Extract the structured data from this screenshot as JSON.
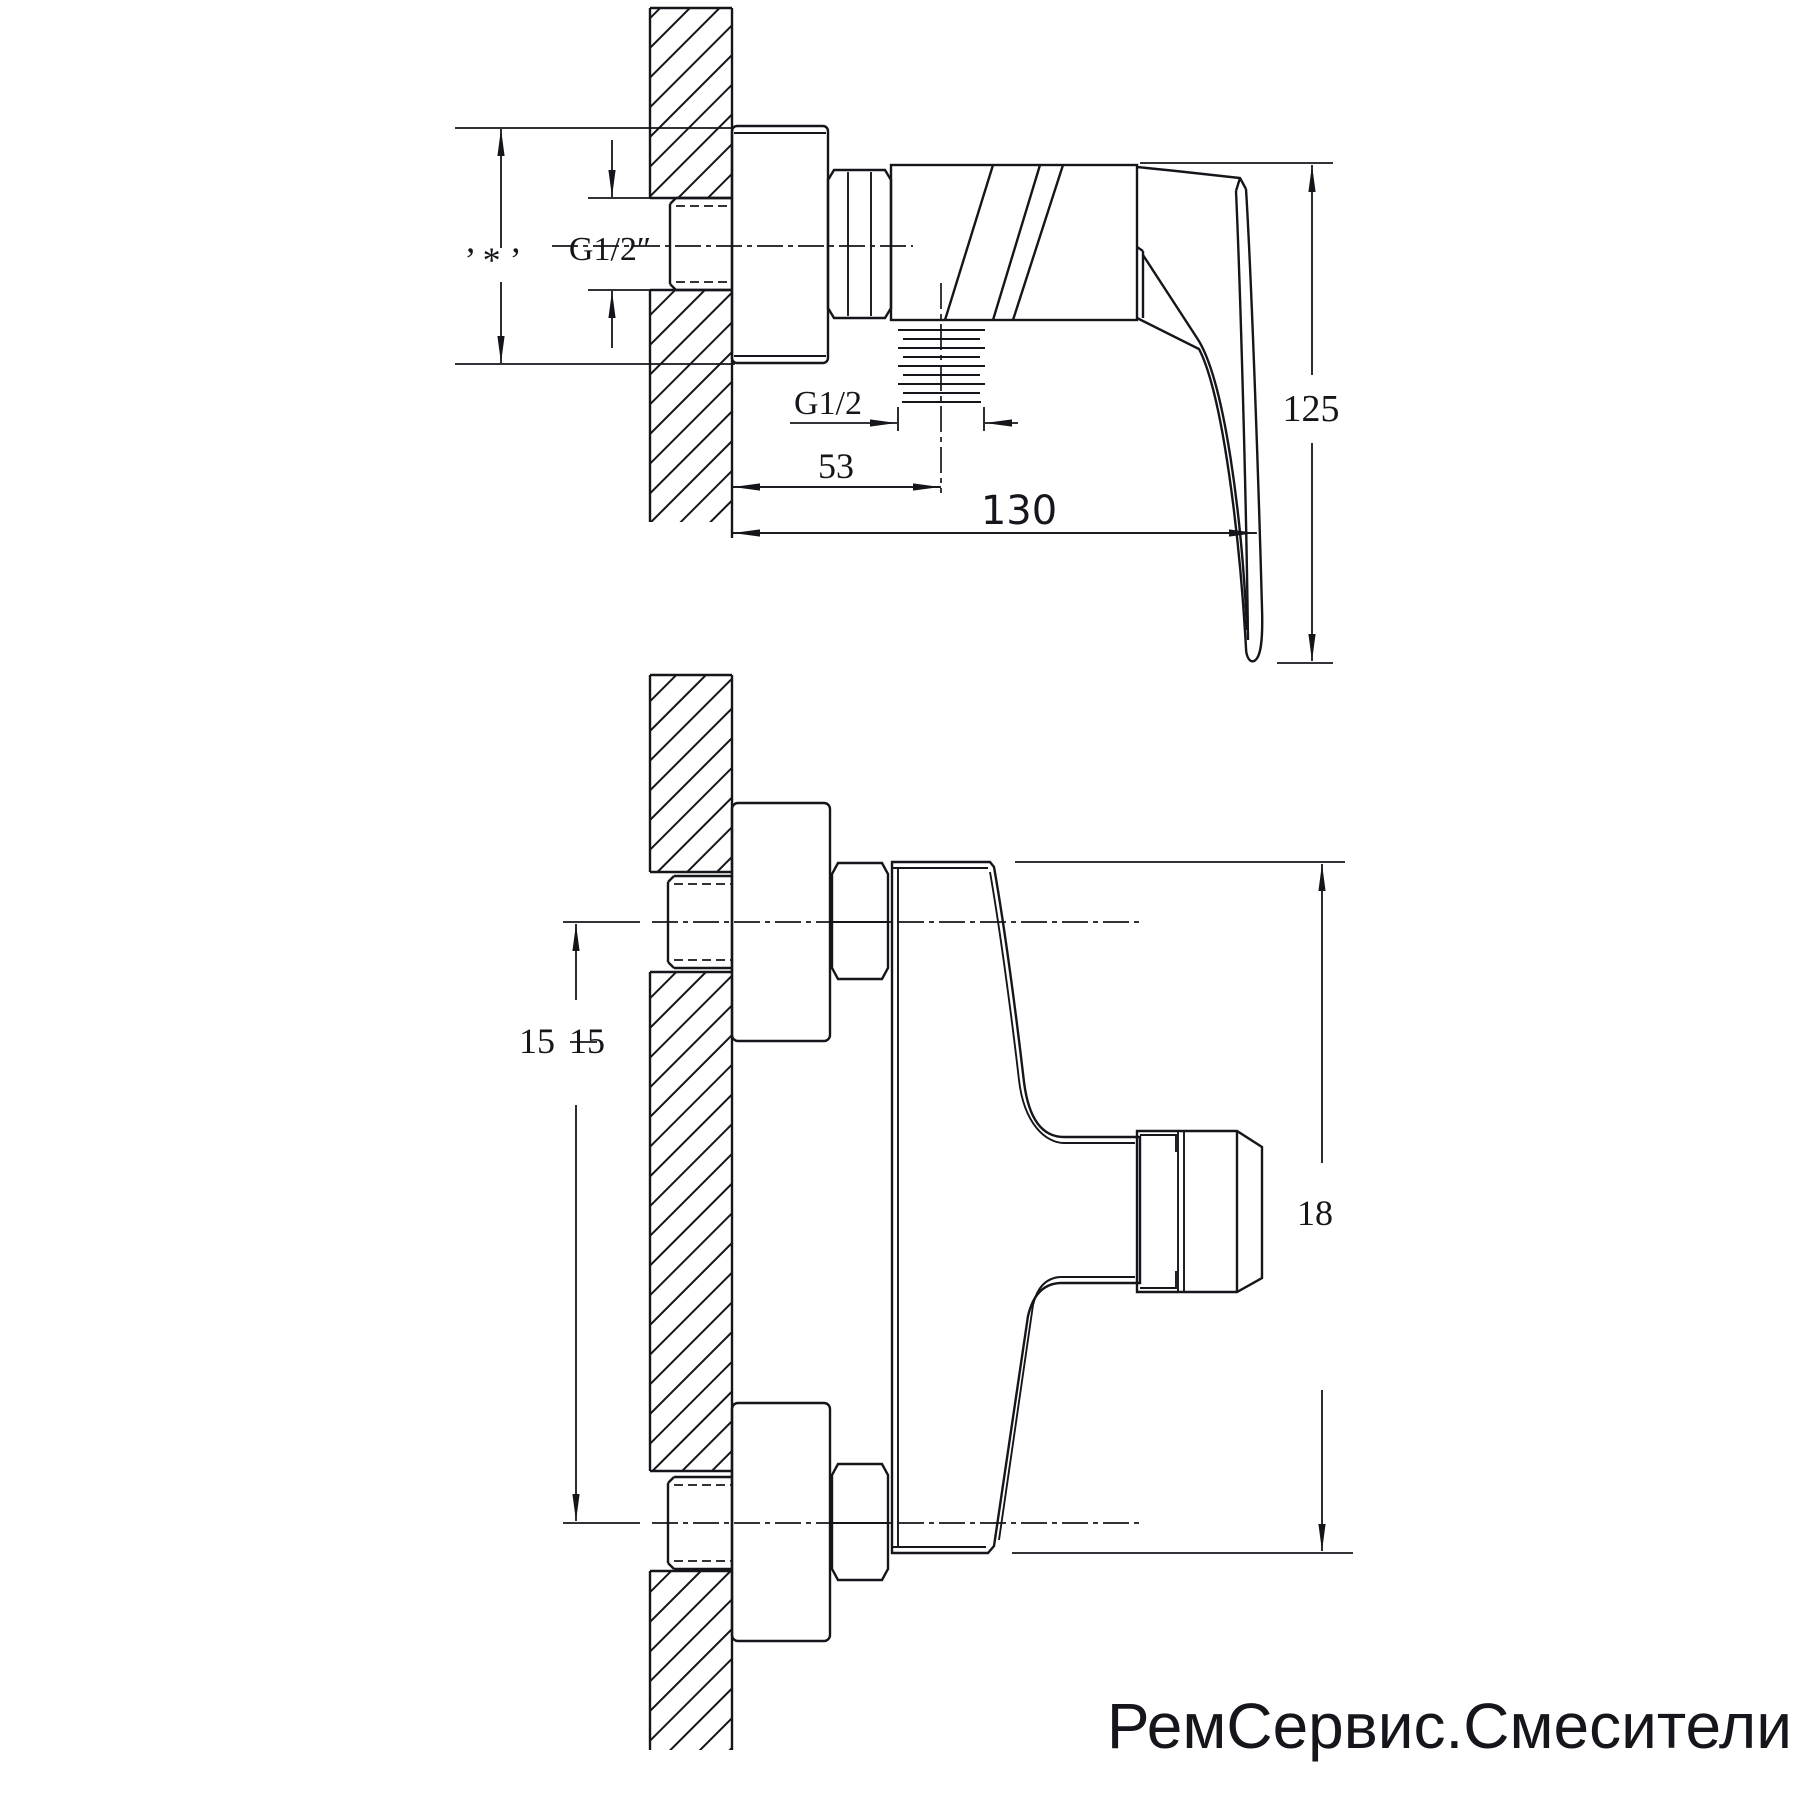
{
  "views": {
    "top": {
      "labels": {
        "star": "’ * ’",
        "thread_wall": "G1/2″",
        "thread_outlet": "G1/2",
        "dim_53": "53",
        "dim_130": "130",
        "dim_125": "125"
      }
    },
    "bottom": {
      "labels": {
        "dim_150_left": "15",
        "dim_150_right": "15",
        "dim_180": "18"
      }
    }
  },
  "watermark": {
    "text": "РемСервис.Смесители",
    "color": "#eba49d"
  },
  "drawing": {
    "line_color": "#15151b",
    "background": "#ffffff"
  }
}
